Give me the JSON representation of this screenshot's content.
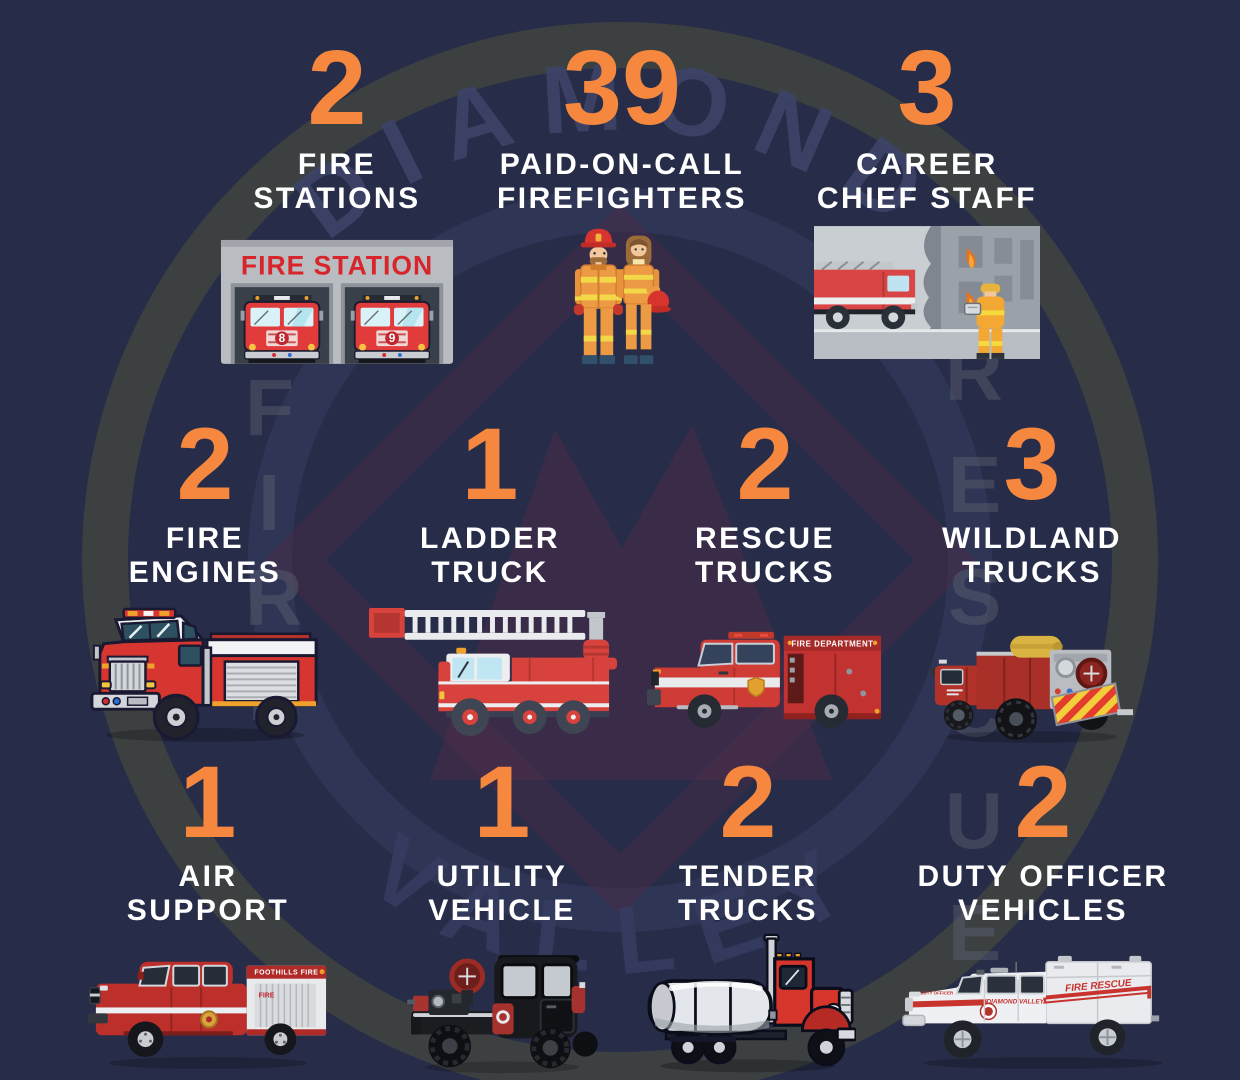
{
  "colors": {
    "background": "#272c48",
    "accent_orange": "#f6873f",
    "label_white": "#ffffff",
    "badge_gray": "#3f433f",
    "badge_maroon": "#4e2c48",
    "fire_red": "#d7352f"
  },
  "watermark": {
    "top_arc": "DIAMOND",
    "bottom_arc": "VALLEY",
    "left_word": "FIRE",
    "right_word": "RESCUE",
    "left_letters": [
      "F",
      "I",
      "R",
      "E"
    ],
    "right_letters": [
      "R",
      "E",
      "S",
      "C",
      "U",
      "E"
    ]
  },
  "stats": {
    "fire_stations": {
      "value": "2",
      "label": "FIRE\nSTATIONS"
    },
    "poc_firefighters": {
      "value": "39",
      "label": "PAID-ON-CALL\nFIREFIGHTERS"
    },
    "career_chief": {
      "value": "3",
      "label": "CAREER\nCHIEF STAFF"
    },
    "fire_engines": {
      "value": "2",
      "label": "FIRE\nENGINES"
    },
    "ladder_truck": {
      "value": "1",
      "label": "LADDER\nTRUCK"
    },
    "rescue_trucks": {
      "value": "2",
      "label": "RESCUE\nTRUCKS"
    },
    "wildland_trucks": {
      "value": "3",
      "label": "WILDLAND\nTRUCKS"
    },
    "air_support": {
      "value": "1",
      "label": "AIR\nSUPPORT"
    },
    "utility_vehicle": {
      "value": "1",
      "label": "UTILITY\nVEHICLE"
    },
    "tender_trucks": {
      "value": "2",
      "label": "TENDER\nTRUCKS"
    },
    "duty_officer": {
      "value": "2",
      "label": "DUTY OFFICER\nVEHICLES"
    }
  },
  "illustrations": {
    "fire_station": {
      "sign": "FIRE STATION",
      "bay_numbers": [
        "8",
        "9"
      ]
    },
    "rescue_truck": {
      "box_text": "FIRE DEPARTMENT"
    },
    "air_support": {
      "box_text": "FOOTHILLS FIRE",
      "front_text": "FIRE"
    },
    "duty_officer": {
      "side_text": "DIAMOND VALLEY",
      "canopy_text": "FIRE RESCUE",
      "fender_text": "DUTY OFFICER"
    }
  },
  "chart_data": {
    "type": "table",
    "title": "Diamond Valley Fire Rescue — department statistics",
    "categories": [
      "Fire Stations",
      "Paid-On-Call Firefighters",
      "Career Chief Staff",
      "Fire Engines",
      "Ladder Truck",
      "Rescue Trucks",
      "Wildland Trucks",
      "Air Support",
      "Utility Vehicle",
      "Tender Trucks",
      "Duty Officer Vehicles"
    ],
    "values": [
      2,
      39,
      3,
      2,
      1,
      2,
      3,
      1,
      1,
      2,
      2
    ],
    "legend_position": "none",
    "grid": false
  }
}
